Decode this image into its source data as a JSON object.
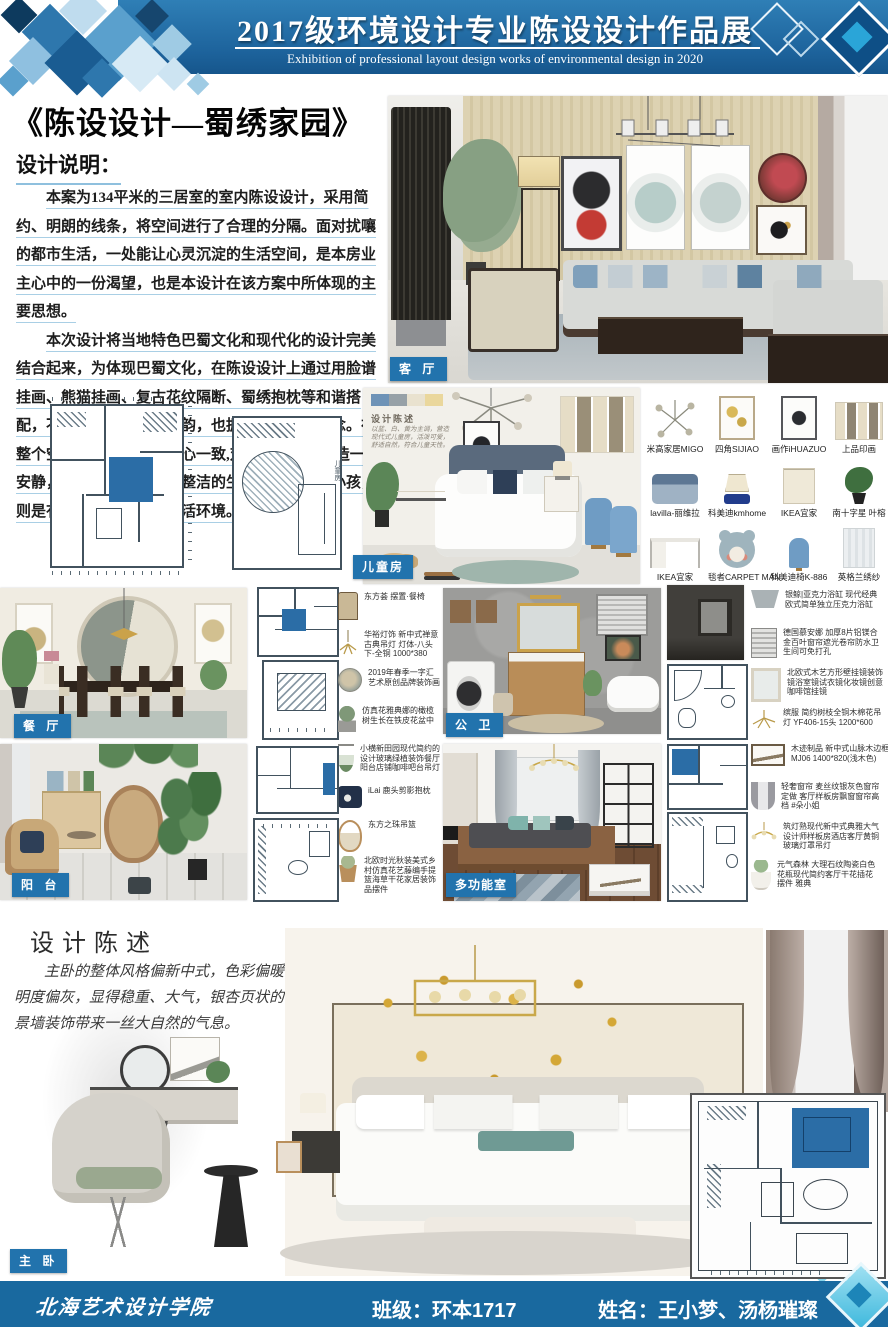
{
  "header": {
    "title": "2017级环境设计专业陈设设计作品展",
    "subtitle": "Exhibition of professional layout design works of environmental design in 2020"
  },
  "intro": {
    "work_title": "《陈设设计—蜀绣家园》",
    "heading": "设计说明：",
    "p1": "本案为134平米的三居室的室内陈设设计，采用简约、明朗的线条，将空间进行了合理的分隔。面对扰嚷的都市生活，一处能让心灵沉淀的生活空间，是本房业主心中的一份渴望，也是本设计在该方案中所体现的主要思想。",
    "p2": "本次设计将当地特色巴蜀文化和现代化的设计完美结合起来，为体现巴蜀文化，在陈设设计上通过用脸谱挂画、熊猫挂画、复古花纹隔断、蜀绣抱枕等和谐搭配，不仅有中国传统的神韵，也拥有新的设计理念。在整个空间的设计上达到身心一致,对于大人必须营造一个安静，优雅，舒心，干净整洁的生活环境，对于小孩，则是有活力有动感的的生活环境。"
  },
  "labels": {
    "living": "客 厅",
    "kids": "儿童房",
    "dining": "餐 厅",
    "bath": "公 卫",
    "balcony": "阳 台",
    "multi": "多功能室",
    "master": "主 卧"
  },
  "kids_note": {
    "title": "设计陈述",
    "body": "以蓝、白、黄为主调，营造现代式儿童房，活泼可爱，舒适自然，符合儿童天性。"
  },
  "plan_note": "儿童房",
  "products": [
    "米高家居MIGO",
    "四角SIJIAO",
    "画作iHUAZUO",
    "上品印画",
    "lavilla-丽维拉",
    "科美迪kmhome",
    "IKEA宜家",
    "南十字星 叶榕",
    "IKEA宜家",
    "毯者CARPET MAN",
    "科美迪椅K-886",
    "英格兰绣纱"
  ],
  "dining_items": [
    "东方荟 摆置·餐椅",
    "华裕灯饰 新中式禅意古典吊灯 灯体-八头下-全铜 1000*380",
    "2019年春季一字汇艺术原创品牌装饰画",
    "仿真花雅典娜的橄榄树生长在铁皮花盆中",
    "小横新田园现代简约的设计玻璃绿植装饰餐厅阳台店铺咖啡吧台吊灯",
    "iLai 鹿头剪影抱枕",
    "东方之珠吊篮",
    "北欧时光秋装美式乡村仿真花艺藤编手提篮海草干花家居装饰品摆件"
  ],
  "bath_items": [
    "银鲸|亚克力浴缸 现代经典欧式简单独立压克力浴缸",
    "德国慕安娜 加厚8片铝镁合金百叶窗帘遮光卷帘防水卫生间可免打孔",
    "北欧式木艺方形壁挂镜装饰镜浴室镜试衣镜化妆镜创意咖啡馆挂镜",
    "缤服 简约树枝全铜木棉花吊灯 YF406-15头 1200*600",
    "木迹制品 新中式山脉木边框 MJ06 1400*820(浅木色)",
    "轻奢窗帘 麦丝纹银灰色窗帘定做 客厅样板房飘窗窗帘高档 #朵小姐",
    "筑灯熟现代新中式典雅大气设计师样板房酒店客厅黄铜玻璃灯罩吊灯",
    "元气森林 大理石纹陶瓷白色花瓶现代简约客厅干花插花摆件 雅典"
  ],
  "statement": {
    "heading": "设计陈述",
    "body": "主卧的整体风格偏新中式，色彩偏暖，明度偏灰，显得稳重、大气，银杏页状的背景墙装饰带来一丝大自然的气息。"
  },
  "footer": {
    "school": "北海艺术设计学院",
    "class_label": "班级：环本1717",
    "names_label": "姓名：王小梦、汤杨璀璨"
  },
  "colors": {
    "banner_blue": "#1d639c",
    "badge_blue": "#2273ad",
    "underline_blue": "#a9cfe5",
    "highlight_room_blue": "#2b6da6",
    "diamond_cyan": "#3fb9dd"
  }
}
